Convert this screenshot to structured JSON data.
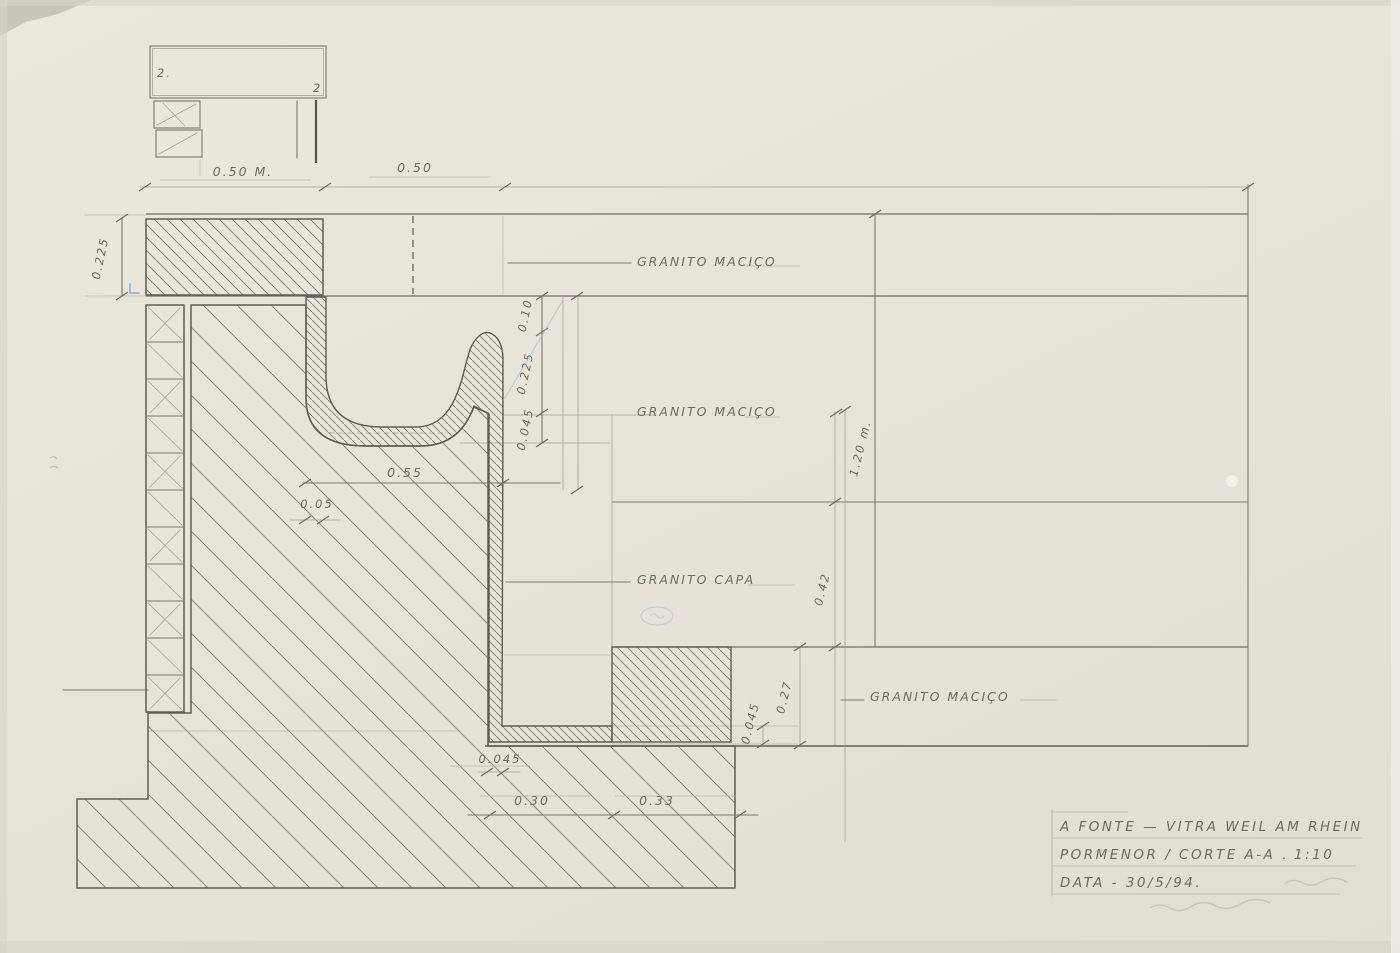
{
  "drawing": {
    "labels": {
      "granito_macico_top": "GRANITO MACIÇO",
      "granito_macico_mid": "GRANITO MACIÇO",
      "granito_capa": "GRANITO CAPA",
      "granito_macico_bottom": "GRANITO MACIÇO"
    },
    "dimensions": {
      "top_width_left": "0.50 M.",
      "top_width_right": "0.50",
      "slab_thickness_left": "0.225",
      "d_010": "0.10",
      "d_0225": "0.225",
      "d_0045_upper": "0.045",
      "d_055": "0.55",
      "d_005": "0.05",
      "d_120": "1.20 m.",
      "d_042": "0.42",
      "d_027": "0.27",
      "d_0045_right": "0.045",
      "d_0045_lower": "0.045",
      "d_030": "0.30",
      "d_033": "0.33"
    },
    "sketch_marks": {
      "left": "2.",
      "right": "2"
    },
    "title_block": {
      "line1": "A FONTE  —  VITRA WEIL AM RHEIN",
      "line2": "PORMENOR / CORTE  A-A .",
      "scale": "1:10",
      "line3": "DATA  -  30/5/94."
    },
    "colors": {
      "paper": "#e8e4da",
      "pencil": "#6f6b61",
      "pencil_light": "#a8a296",
      "blue_accent": "#9cbccd"
    }
  }
}
